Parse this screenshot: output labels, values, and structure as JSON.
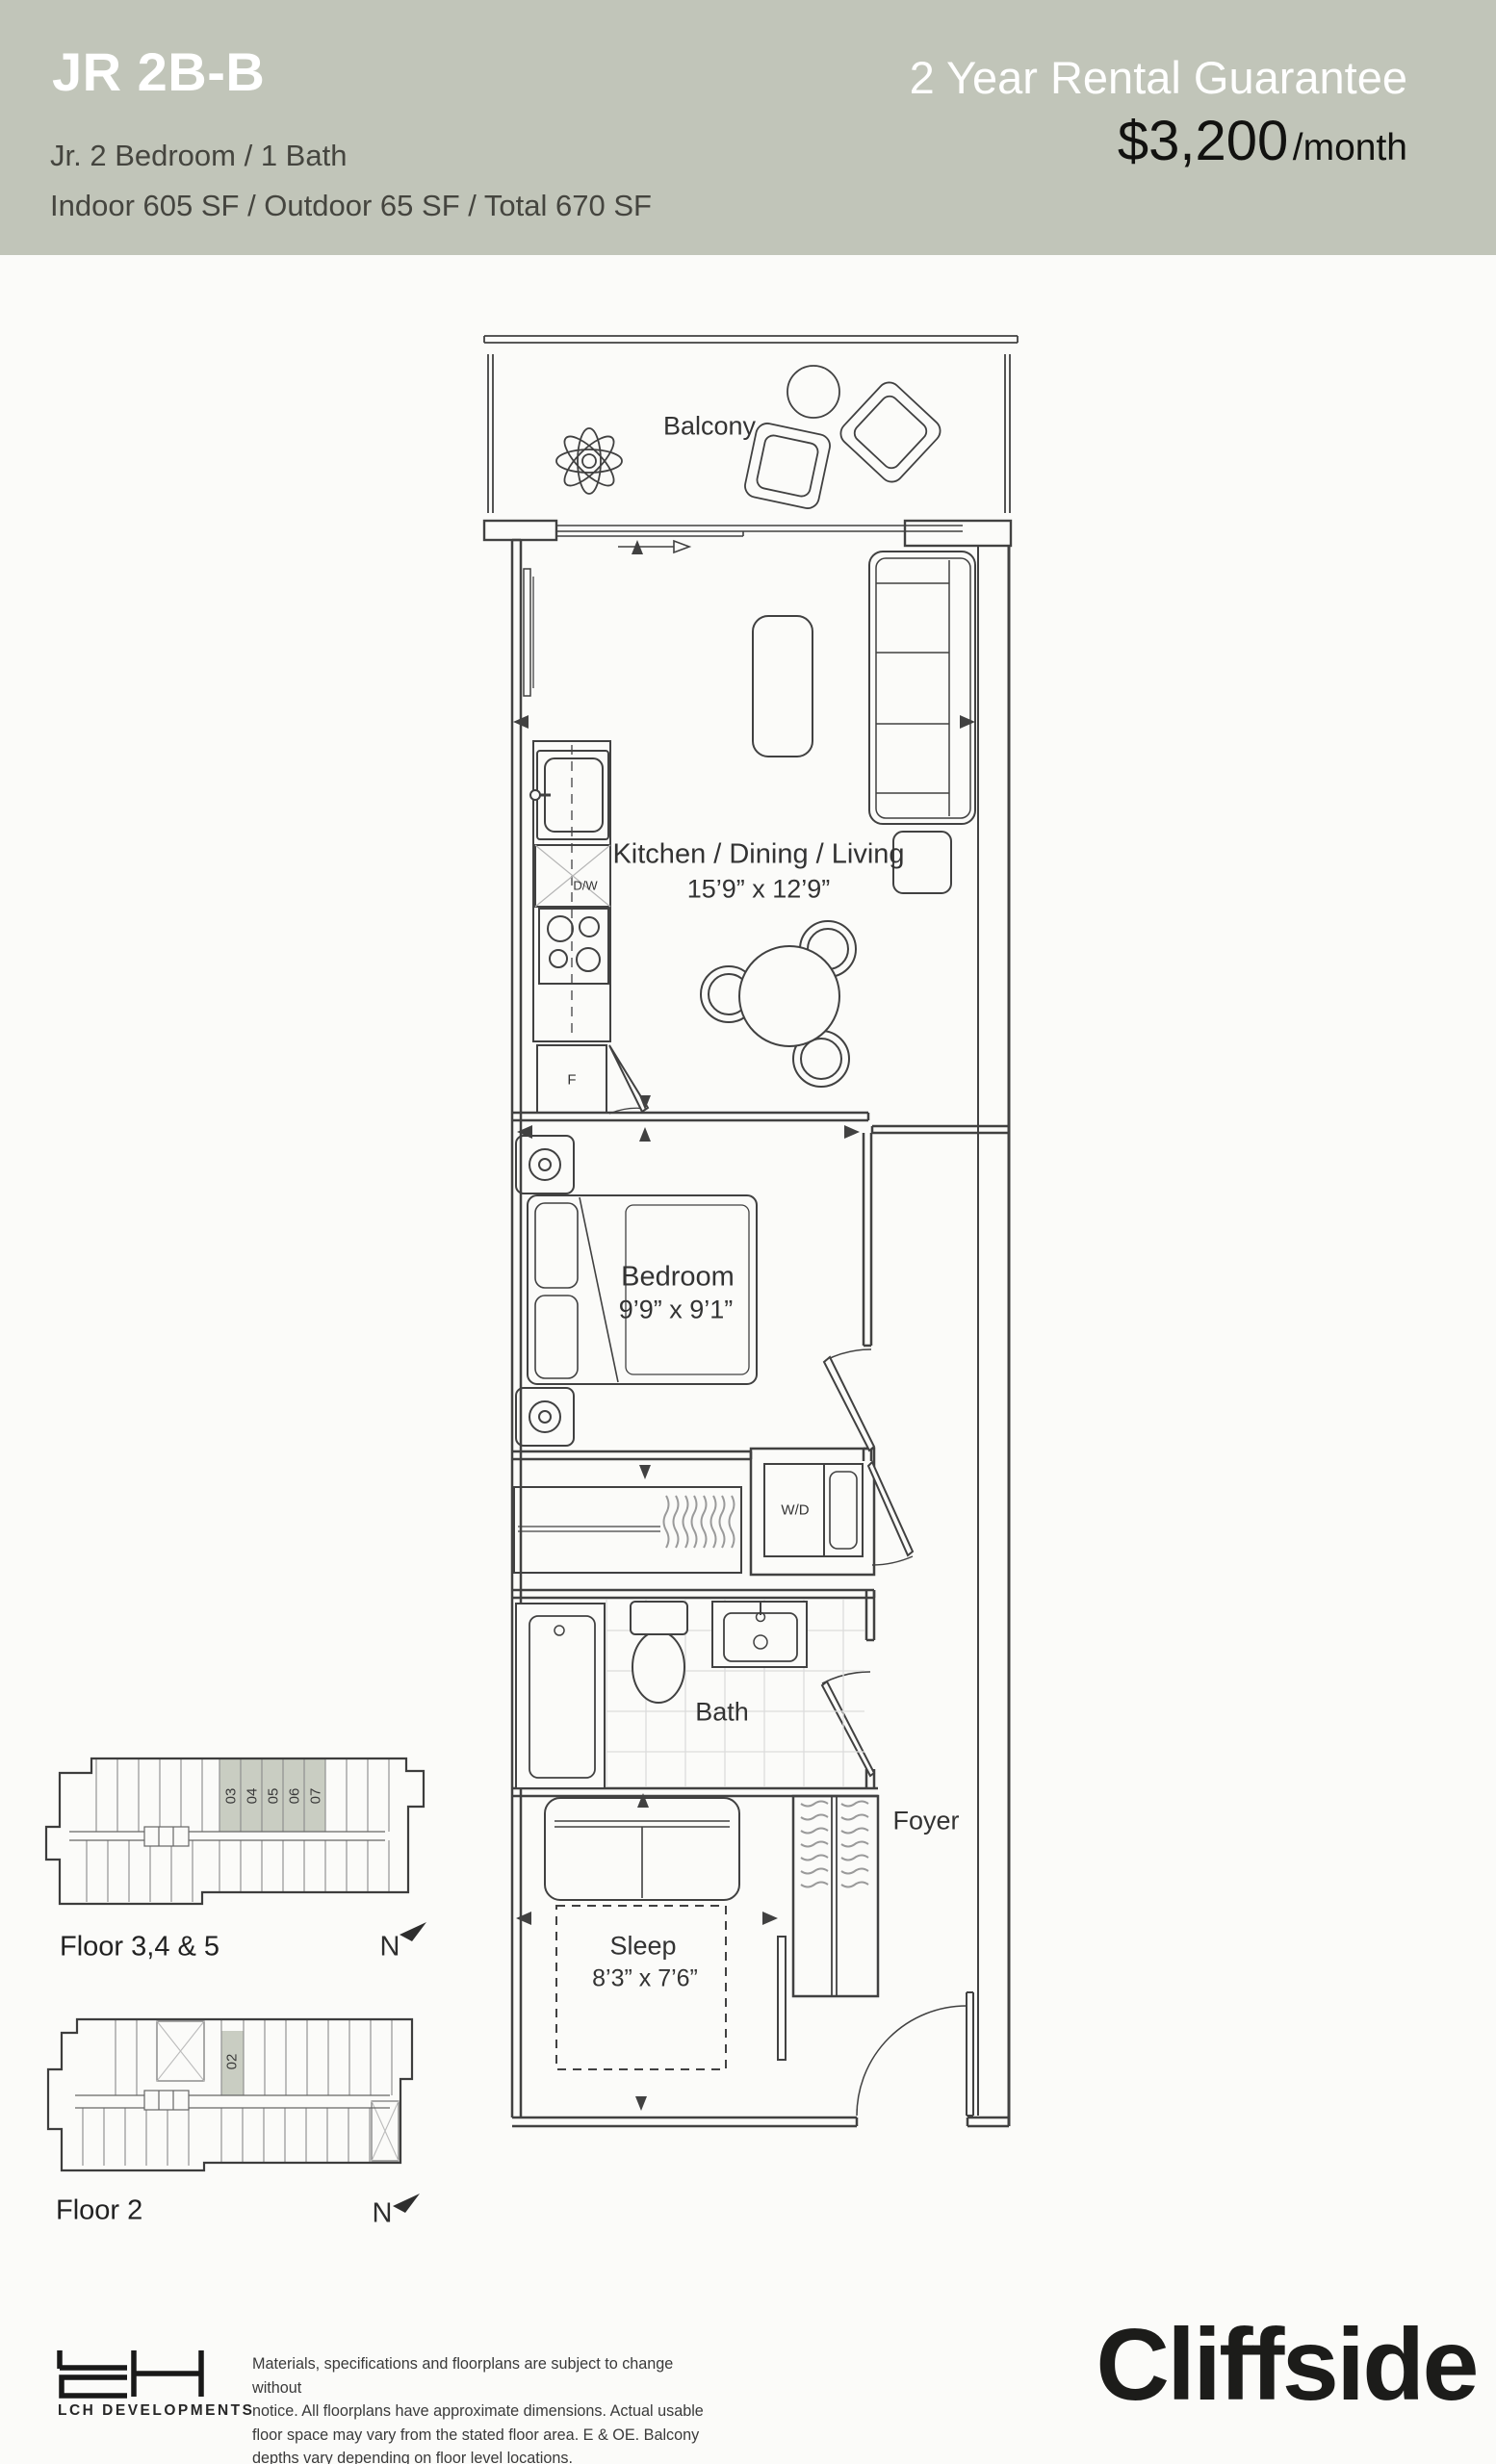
{
  "header": {
    "unit_name": "JR 2B-B",
    "config": "Jr. 2 Bedroom  /  1 Bath",
    "areas": "Indoor 605 SF  /  Outdoor 65 SF  /  Total 670 SF",
    "guarantee": "2 Year Rental Guarantee",
    "price": "$3,200",
    "price_unit": "/month"
  },
  "plan": {
    "balcony_label": "Balcony",
    "kitchen_label": "Kitchen / Dining / Living",
    "kitchen_dims": "15’9” x 12’9”",
    "bedroom_label": "Bedroom",
    "bedroom_dims": "9’9” x 9’1”",
    "sleep_label": "Sleep",
    "sleep_dims": "8’3” x 7’6”",
    "bath_label": "Bath",
    "foyer_label": "Foyer",
    "appliances": {
      "dishwasher": "D/W",
      "fridge": "F",
      "washer_dryer": "W/D"
    }
  },
  "keyplans": [
    {
      "label": "Floor 3,4 & 5",
      "north": "N",
      "units": [
        "03",
        "04",
        "05",
        "06",
        "07"
      ]
    },
    {
      "label": "Floor 2",
      "north": "N",
      "units": [
        "02"
      ]
    }
  ],
  "footer": {
    "developer": "LCH DEVELOPMENTS",
    "disclaimer_lines": [
      "Materials, specifications and floorplans are subject to change without",
      "notice. All floorplans have approximate dimensions. Actual usable",
      "floor space may vary from the stated floor area. E & OE. Balcony",
      "depths vary depending on floor level locations."
    ],
    "brand": "Cliffside"
  },
  "colors": {
    "header_bg": "#c1c5b9",
    "line": "#414141",
    "tile": "#dcdcdc",
    "unit_highlight": "#c9cdc2"
  }
}
